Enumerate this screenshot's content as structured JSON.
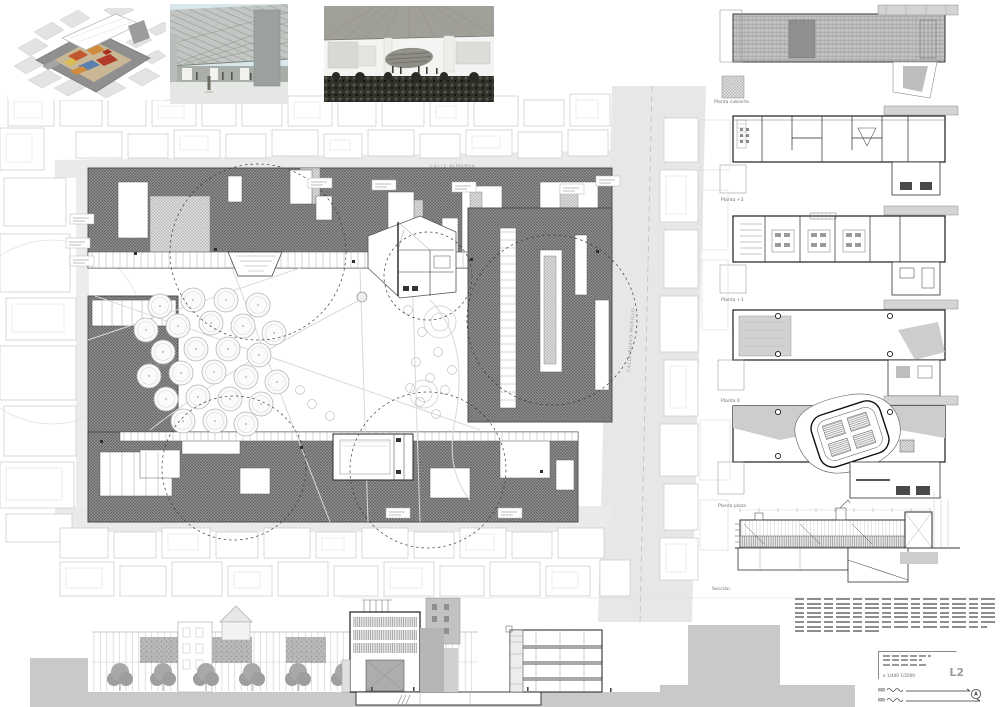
{
  "site_plan": {
    "street_top_label": "CALLE ALMANSA",
    "street_right_label": "CALLE BRAVO MURILLO",
    "street_bottom_label": "CALLE DOCTOR SANTERO"
  },
  "right_column": {
    "labels": [
      "Planta cubierta",
      "Planta +2",
      "Planta +1",
      "Planta 0",
      "Planta plaza",
      "Sección"
    ]
  },
  "title_block": {
    "scale_text": "e 1/400  1/2000",
    "sheet_code": "L2"
  },
  "colors": {
    "roof_hatch_gray": "#8f8f8f",
    "ground_gray": "#c9c9c9",
    "street_gray": "#eaeaea",
    "render_orange": "#c0572e",
    "render_blue": "#5d7fae",
    "render_sky": "#d8e7ea"
  }
}
